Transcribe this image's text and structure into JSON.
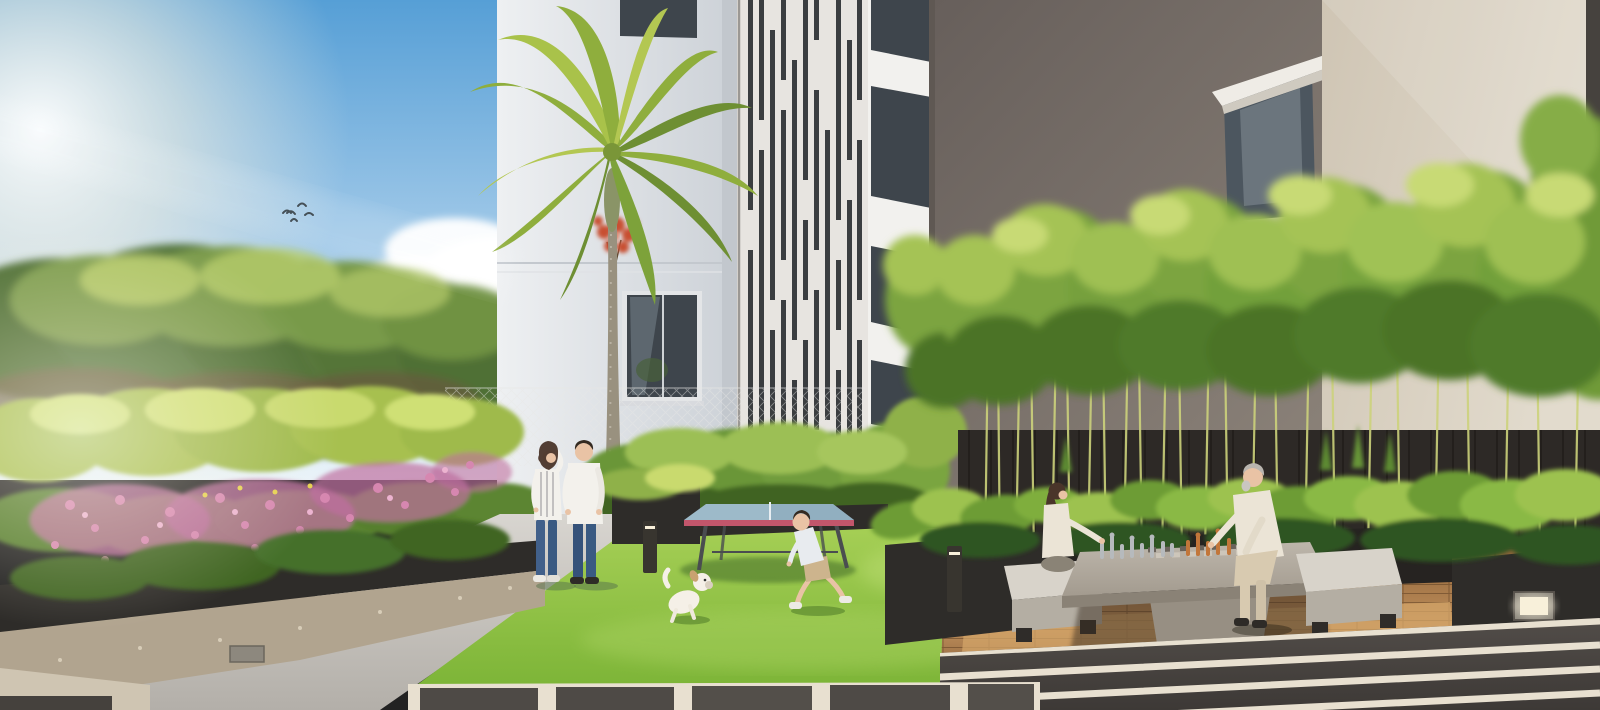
{
  "meta": {
    "type": "architectural-rendering",
    "description": "Residential courtyard amenity render: a couple chatting on a path, a child playing with a white puppy on a lawn beside an outdoor table-tennis table, a girl and a senior man playing chess on a concrete games table among bamboo and hosta planters, modern white and grey apartment facades, a tall palm, blue sky with clouds and birds, striped gravel paving in the foreground."
  },
  "scene": {
    "objects": [
      "sky",
      "sun-glare",
      "clouds",
      "birds",
      "left-tree-canopy",
      "flower-planter",
      "left-apartment-building",
      "palm-tree",
      "slat-feature-wall",
      "near-white-facade",
      "grey-concrete-wall",
      "boxed-window",
      "beige-wall",
      "bamboo-screen",
      "privacy-fence",
      "hosta-planters",
      "walking-path",
      "lawn",
      "table-tennis-table",
      "wood-deck",
      "giant-chess-table",
      "chess-pieces",
      "chess-benches",
      "bollard-lights",
      "step-lights",
      "striped-gravel-paving",
      "paver-walkway"
    ],
    "people": [
      "woman-standing",
      "man-standing",
      "child-playing",
      "girl-playing-chess",
      "senior-man-playing-chess"
    ],
    "animals": [
      "white-puppy"
    ]
  },
  "colors": {
    "sky_top": "#569fd6",
    "sky_mid": "#a8cdea",
    "sky_horizon": "#e9f3f9",
    "sun_glow": "#fff6e3",
    "cloud": "#ffffff",
    "bird": "#2b3740",
    "tree_dark": "#4f7034",
    "tree_mid": "#6f9243",
    "tree_light": "#b7cd6b",
    "understory": "#6f5f40",
    "bld_left_light": "#eef0f2",
    "bld_left_shade": "#ccd1d7",
    "window_glass": "#3e454c",
    "frame_light": "#e3e5e7",
    "slat_wall": "#e7e4e0",
    "slat_dark": "#3a3d40",
    "facade_white": "#f2f1ee",
    "wall_grey_dark": "#675f5b",
    "wall_grey_light": "#8a8178",
    "wall_beige_dark": "#cfc5b4",
    "wall_beige_light": "#e2dbcd",
    "corner_dark": "#46423e",
    "bamboo_mid": "#7ca43f",
    "bamboo_light": "#a5c355",
    "bamboo_dark": "#4c7328",
    "bamboo_tip": "#c8da74",
    "bamboo_stem": "#ccd27b",
    "hosta_green": "#6d9c35",
    "hosta_dark": "#2f5520",
    "hosta_light": "#9dc24f",
    "fence_dark": "#2d2926",
    "planter_dark": "#2e2c29",
    "stone_base": "#b1a48f",
    "path_light": "#d8d5d0",
    "path_dark": "#b3afa9",
    "lawn_top": "#a9d158",
    "lawn_bottom": "#7cb437",
    "lawn_shade": "#5f9a2c",
    "palm_trunk": "#99917f",
    "palm_green": "#8fae3d",
    "palm_green_dark": "#6e8f33",
    "palm_green_light": "#b3c752",
    "red_plant": "#c84f31",
    "deck_light": "#c0905c",
    "deck_dark": "#8a5e35",
    "pave_dark": "#524d49",
    "gravel": "#e8e0d0",
    "tt_top": "#9dbac9",
    "tt_edge": "#c2566b",
    "tt_leg": "#4a4d50",
    "flower_pink": "#d687b0",
    "flower_pink_deep": "#b05e8f",
    "flower_light": "#ecb3d0",
    "skin": "#e9c3a5",
    "hair_dark": "#342a21",
    "hair_brown": "#4a352a",
    "hair_grey": "#b9b5af",
    "shirt_white": "#f3f1ec",
    "jeans": "#41608a",
    "jeans_dark": "#35527a",
    "sneaker_white": "#eceae4",
    "shoe_dark": "#2e2b27",
    "child_shirt": "#e8ebef",
    "shorts_khaki": "#cdb48d",
    "dog_white": "#f5f0e7",
    "dog_shade": "#d9cfc0",
    "cream": "#ebe4d6",
    "pants_beige": "#d8cab0",
    "silver": "#b6babd",
    "copper": "#c2763a",
    "bench": "#d8d3ca",
    "bench_shade": "#b4aea3",
    "table_top": "#bdb6ab",
    "table_side": "#978f83",
    "bollard": "#38352f",
    "light_warm": "#f8f0da"
  }
}
